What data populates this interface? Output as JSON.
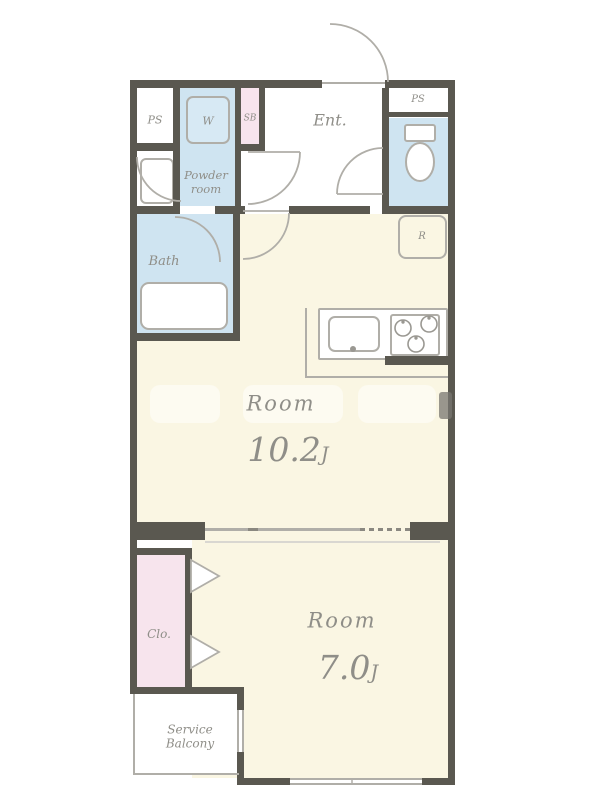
{
  "title": "Apartment floor plan",
  "rooms": {
    "ps_left": "PS",
    "washer": "W",
    "sb": "SB",
    "entrance": "Ent.",
    "ps_right": "PS",
    "powder_line1": "Powder",
    "powder_line2": "room",
    "bath": "Bath",
    "refrigerator": "R",
    "main_room_name": "Room",
    "main_room_size": "10.2",
    "main_room_unit": "J",
    "bedroom_name": "Room",
    "bedroom_size": "7.0",
    "bedroom_unit": "J",
    "closet": "Clo.",
    "balcony_line1": "Service",
    "balcony_line2": "Balcony"
  },
  "colors": {
    "wall": "#5a5850",
    "room_cream": "#faf6e3",
    "wet_blue": "#cfe4f1",
    "accent_pink": "#f7e4ed",
    "line_gray": "#b0aea8",
    "label_gray": "#8f8e88"
  }
}
